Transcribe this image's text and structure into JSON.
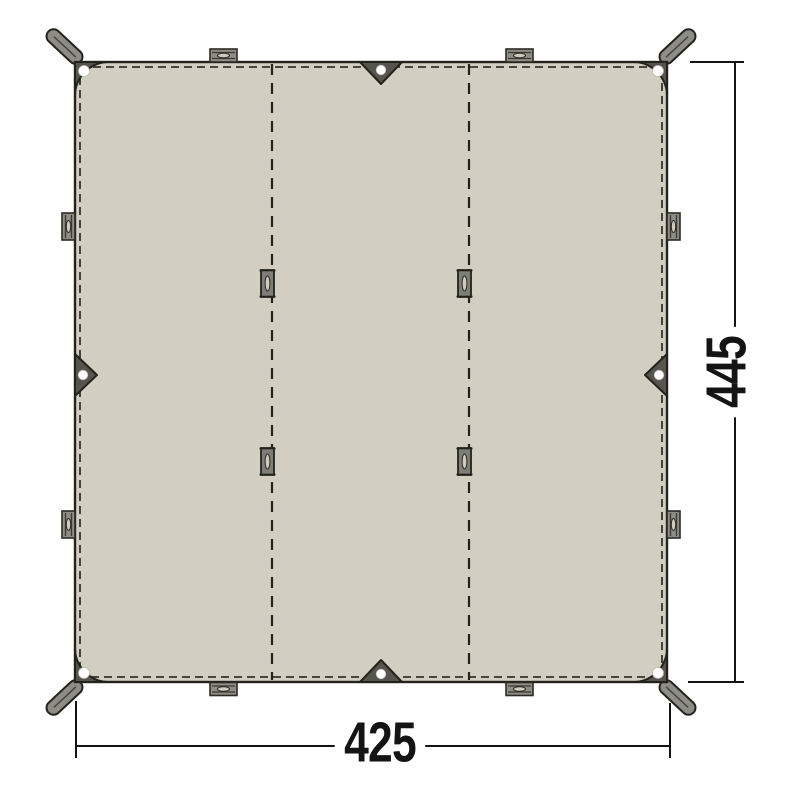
{
  "diagram": {
    "kind": "tarp-floorplan-technical-drawing"
  },
  "dimensions": {
    "width": "425",
    "height": "445"
  },
  "parts": {
    "panels": 3,
    "corner_straps": 4,
    "corner_grommets": 4,
    "edge_triangles": 4,
    "edge_triangle_grommets": 4,
    "edge_tabs": 8,
    "seam_loops": 4
  },
  "colors": {
    "background": "#ffffff",
    "tarp_fill": "#d2cfc2",
    "tarp_outline": "#23221d",
    "stitch": "#34332c",
    "hardware_dark": "#56554d",
    "webbing_gray": "#8e8d85",
    "loop_gray": "#7f7e76",
    "grommet_white": "#ffffff",
    "dimension_line": "#141414",
    "dimension_text": "#141414"
  }
}
